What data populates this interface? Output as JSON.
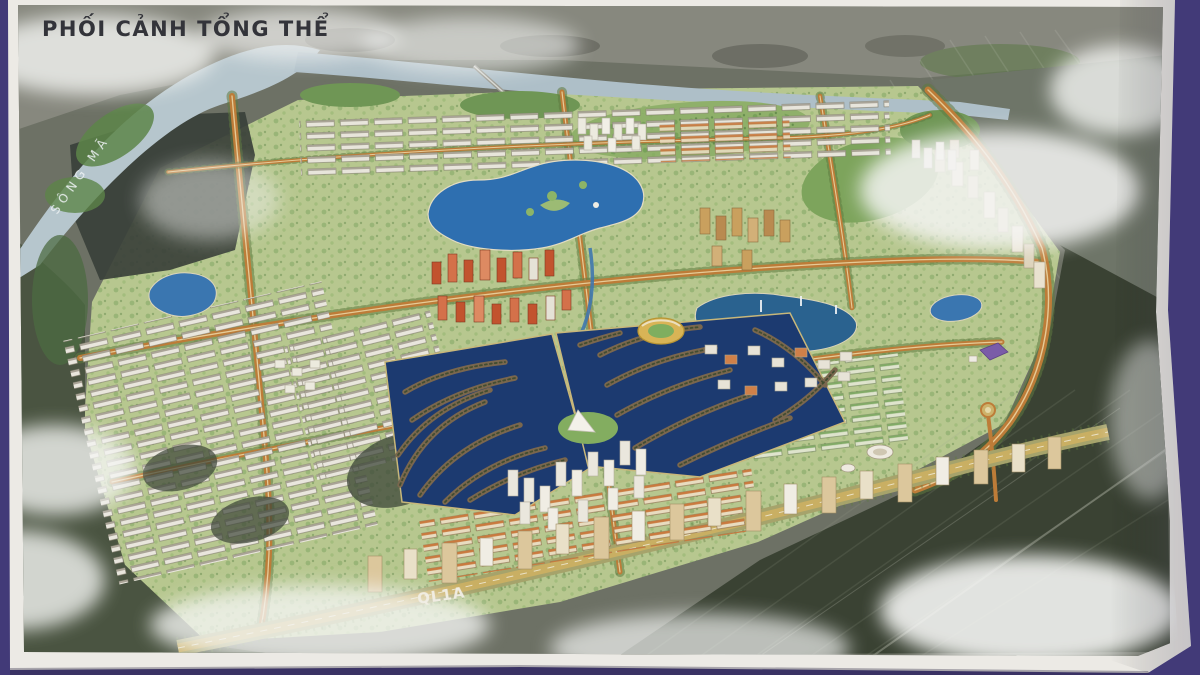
{
  "poster": {
    "title": "PHỐI CẢNH TỔNG THỂ",
    "river_label": "SÔNG MÃ",
    "highway_label": "QL1A",
    "palette": {
      "board_purple": "#423a78",
      "paper_white": "#eceae5",
      "photo_gray": "#87887e",
      "old_town_dark": "#39403a",
      "farmland_dark": "#3a4233",
      "plan_green": "#b7c78f",
      "forest_green": "#6f9655",
      "river_blue": "#b6c6cd",
      "lake_blue": "#2e6fb0",
      "lagoon_navy": "#1c3a70",
      "road_orange": "#bd7c38",
      "highway_tan": "#c9af63",
      "tower_beige": "#dcc79c",
      "tower_red": "#c2532e",
      "cloud_white": "#f4f5f3",
      "title_ink": "#33343a"
    }
  }
}
